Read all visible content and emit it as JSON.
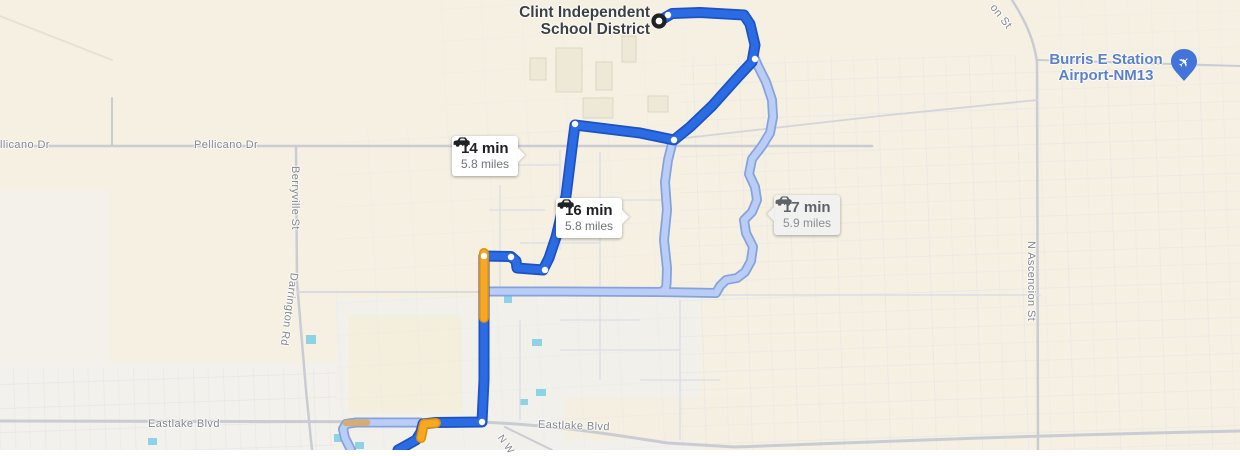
{
  "map": {
    "destination": {
      "line1": "Clint Independent",
      "line2": "School District"
    },
    "airport": {
      "line1": "Burris E Station",
      "line2": "Airport-NM13"
    },
    "routes": [
      {
        "id": "route-14",
        "time": "14 min",
        "distance": "5.8 miles",
        "selected": true
      },
      {
        "id": "route-16",
        "time": "16 min",
        "distance": "5.8 miles",
        "selected": false
      },
      {
        "id": "route-17",
        "time": "17 min",
        "distance": "5.9 miles",
        "selected": false
      }
    ],
    "streets": {
      "pellicano_left": "llicano Dr",
      "pellicano": "Pellicano Dr",
      "berryville": "Berryville St",
      "darrington": "Darrington Rd",
      "eastlake_left": "Eastlake Blvd",
      "eastlake_mid": "Eastlake Blvd",
      "ascencion": "N Ascencion St",
      "ascencion_top": "on St",
      "nw_partial": "N W"
    },
    "icons": {
      "car": "car-icon",
      "airplane": "airplane-icon",
      "destination": "destination-ring-marker"
    }
  },
  "colors": {
    "route_primary": "#2c6ce3",
    "route_primary_dark": "#1c51c8",
    "route_alt": "#b9cdf6",
    "route_alt_dark": "#86a2dc",
    "traffic_orange": "#f7a722",
    "traffic_orange_dark": "#df8e0c",
    "traffic_tan": "#d7ab72",
    "marker_black": "#202124",
    "airport_pin": "#4274d9",
    "airport_text": "#5a80ca",
    "badge_bg": "#ffffff",
    "badge_alt_bg": "#f1f1ef",
    "time_color": "#202124",
    "time_alt_color": "#5f6368",
    "miles_color": "#6f7377",
    "miles_alt_color": "#8a8e92",
    "street_label": "#83868d",
    "dest_label": "#3d4043"
  }
}
